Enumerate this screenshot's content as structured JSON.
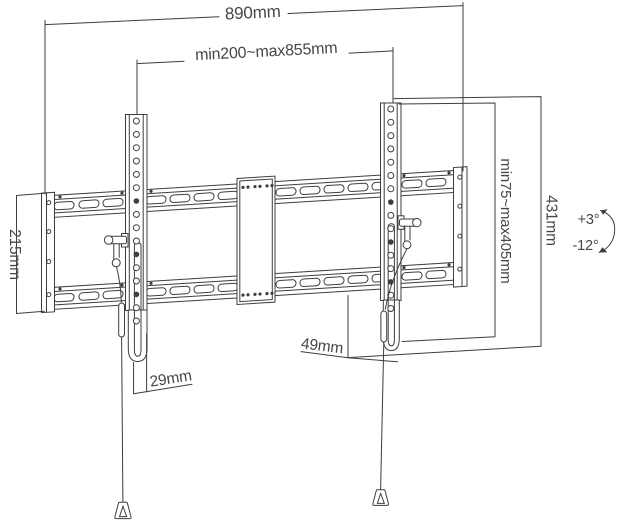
{
  "diagram": {
    "title": "tilting-tv-wall-mount-dimension-drawing",
    "labels": {
      "total_width": "890mm",
      "mounting_span": "min200~max855mm",
      "plate_height": "215mm",
      "bracket_range": "min75~max405mm",
      "bracket_height": "431mm",
      "right_bottom_offset": "49mm",
      "left_bottom_offset": "29mm",
      "tilt_up": "+3°",
      "tilt_down": "-12°"
    },
    "colors": {
      "line": "#3e3e3e",
      "text": "#474747",
      "background": "#ffffff"
    }
  }
}
